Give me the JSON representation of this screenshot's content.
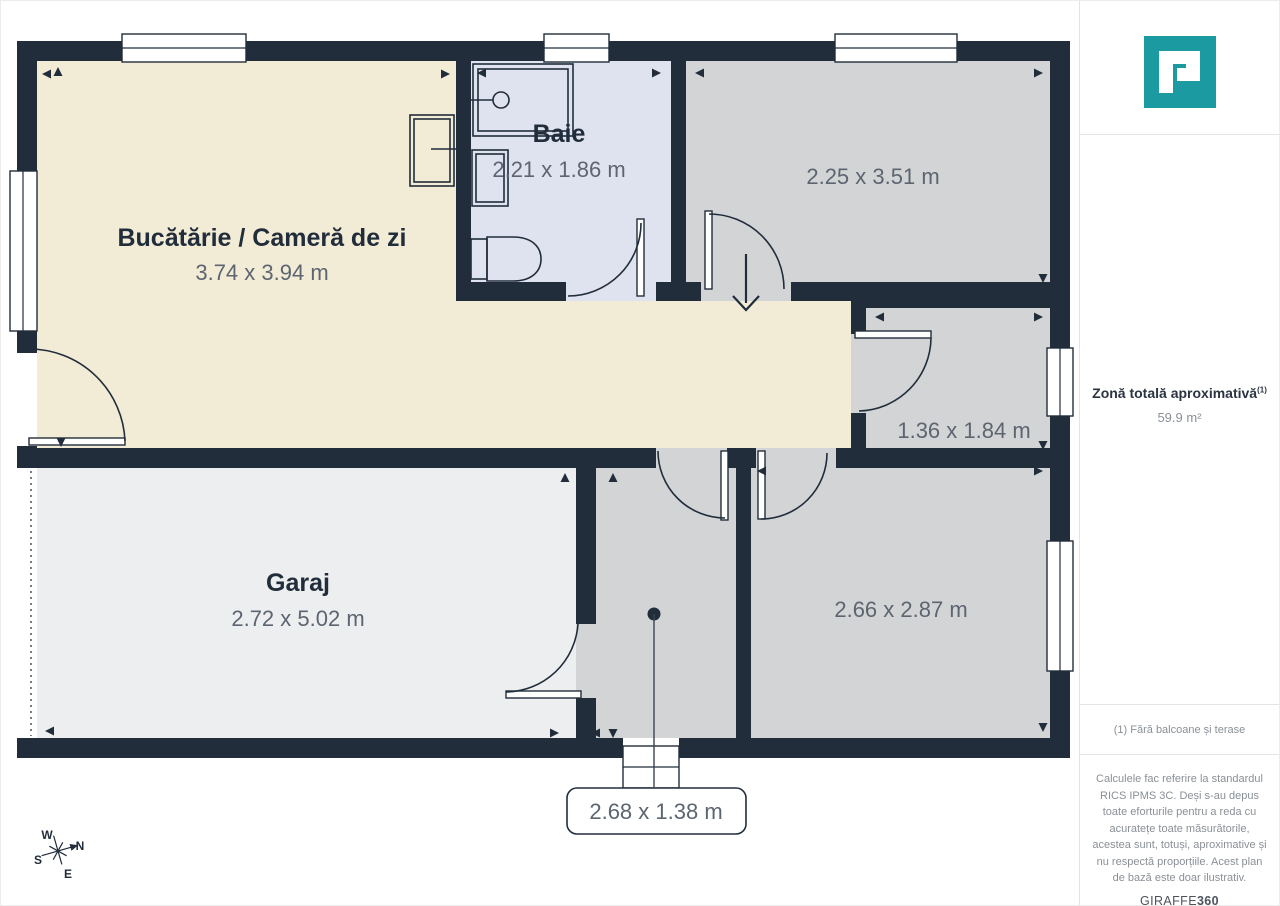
{
  "plan": {
    "rooms": {
      "kitchen": {
        "name": "Bucătărie / Cameră de zi",
        "dims": "3.74 x 3.94 m"
      },
      "bath": {
        "name": "Baie",
        "dims": "2.21 x 1.86 m"
      },
      "top_right": {
        "dims": "2.25 x 3.51 m"
      },
      "small_right": {
        "dims": "1.36 x 1.84 m"
      },
      "garage": {
        "name": "Garaj",
        "dims": "2.72 x 5.02 m"
      },
      "bottom_right": {
        "dims": "2.66 x 2.87 m"
      },
      "entry_hall": {
        "dims": "2.68 x 1.38 m"
      }
    },
    "compass": {
      "n": "N",
      "s": "S",
      "e": "E",
      "w": "W"
    },
    "colors": {
      "wall": "#212d3b",
      "cream": "#f2ebd5",
      "bath": "#dfe3f0",
      "gray": "#d3d4d6",
      "garage": "#edeef0",
      "ink": "#222d3b",
      "dim": "#5d6570",
      "teal": "#1b9aa2"
    }
  },
  "sidebar": {
    "area_title": "Zonă totală aproximativă",
    "area_sup": "(1)",
    "area_value": "59.9 m²",
    "footnote": "(1) Fără balcoane și terase",
    "disclaimer": "Calculele fac referire la standardul RICS IPMS 3C. Deși s-au depus toate eforturile pentru a reda cu acuratețe toate măsurătorile, acestea sunt, totuși, aproximative și nu respectă proporțiile. Acest plan de bază este doar ilustrativ.",
    "brand": {
      "name": "GIRAFFE",
      "suffix": "360"
    }
  }
}
